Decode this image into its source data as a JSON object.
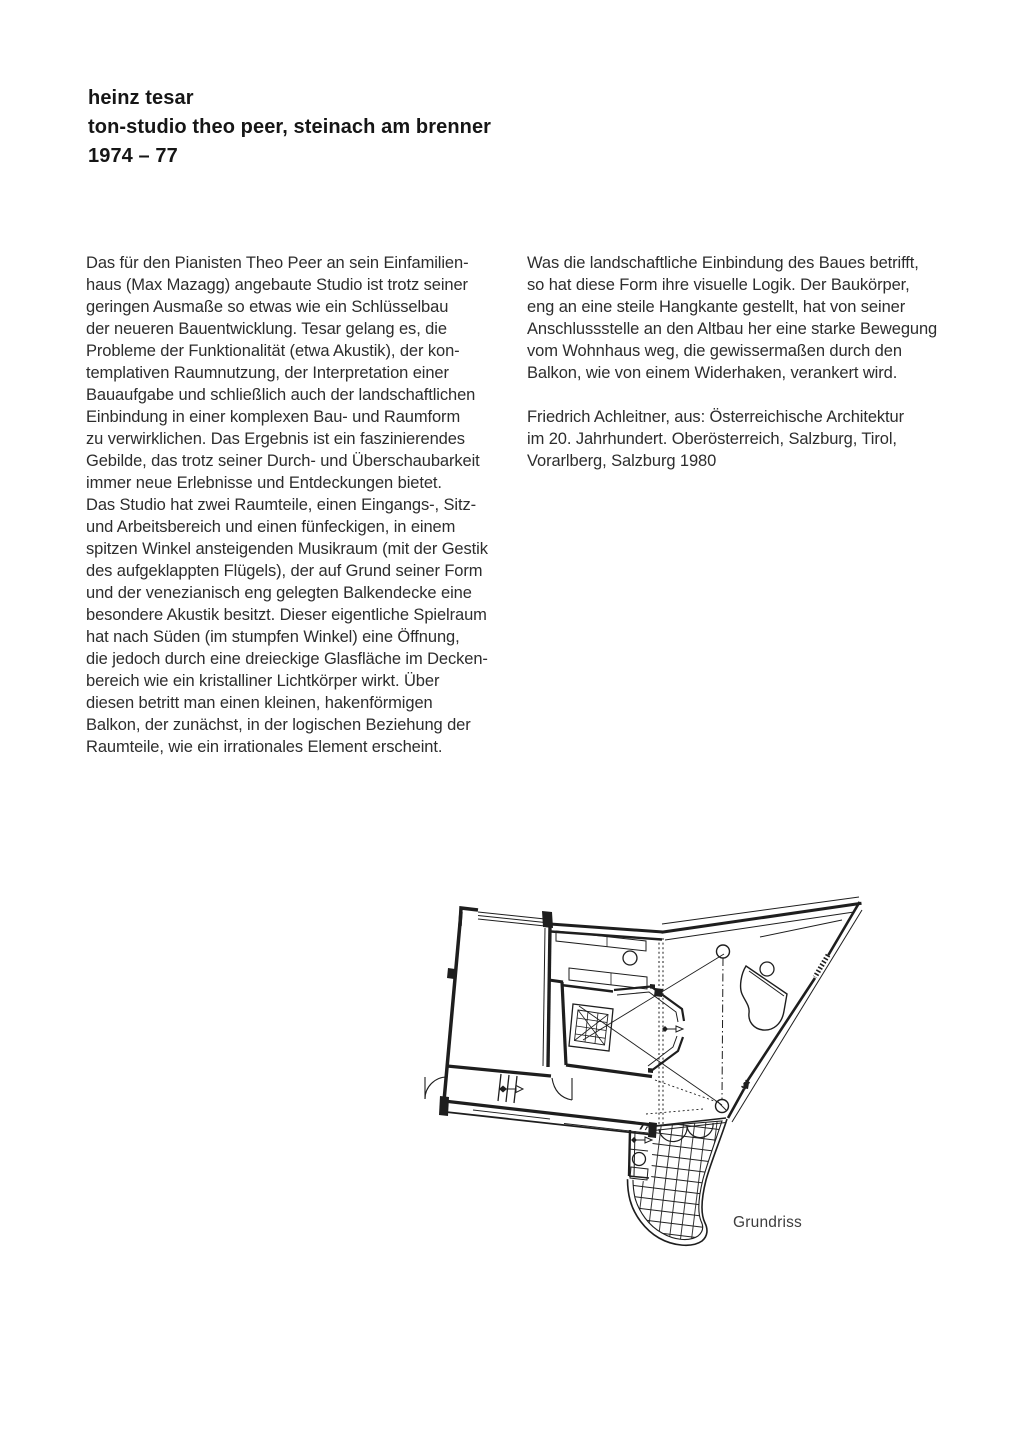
{
  "colors": {
    "background": "#ffffff",
    "text": "#2d2d2d",
    "heading": "#161616",
    "ink": "#1e1e1e",
    "caption": "#3d3d3d"
  },
  "header": {
    "line1": "heinz tesar",
    "line2": "ton-studio theo peer, steinach am brenner",
    "line3": "1974 – 77"
  },
  "columns": {
    "left_lines": [
      "Das für den Pianisten Theo Peer an sein Einfamilien-",
      "haus (Max Mazagg) angebaute Studio ist trotz seiner",
      "geringen Ausmaße so etwas wie ein Schlüsselbau",
      "der neueren Bauentwicklung. Tesar gelang es, die",
      "Probleme der Funktionalität (etwa Akustik), der kon-",
      "templativen Raumnutzung, der Interpretation einer",
      "Bauaufgabe und schließlich auch der landschaftlichen",
      "Einbindung in einer komplexen Bau- und Raumform",
      "zu verwirklichen. Das Ergebnis ist ein faszinierendes",
      "Gebilde, das trotz seiner Durch- und Überschaubarkeit",
      "immer neue Erlebnisse und Entdeckungen bietet.",
      "Das Studio hat zwei Raumteile, einen Eingangs-, Sitz-",
      "und Arbeitsbereich und einen fünfeckigen, in einem",
      "spitzen Winkel ansteigenden Musikraum (mit der Gestik",
      "des aufgeklappten Flügels), der auf Grund seiner Form",
      "und der venezianisch eng gelegten Balkendecke eine",
      "besondere Akustik besitzt. Dieser eigentliche Spielraum",
      "hat nach Süden (im stumpfen Winkel) eine Öffnung,",
      "die jedoch durch eine dreieckige Glasfläche im Decken-",
      "bereich wie ein kristalliner Lichtkörper wirkt. Über",
      "diesen betritt man einen kleinen, hakenförmigen",
      "Balkon, der zunächst, in der logischen Beziehung der",
      "Raumteile, wie ein irrationales Element erscheint."
    ],
    "right_para1_lines": [
      "Was die landschaftliche Einbindung des Baues betrifft,",
      "so hat diese Form ihre visuelle Logik. Der Baukörper,",
      "eng an eine steile Hangkante gestellt, hat von seiner",
      "Anschlussstelle an den Altbau her eine starke Bewegung",
      "vom Wohnhaus weg, die gewissermaßen durch den",
      "Balkon, wie von einem Widerhaken, verankert wird."
    ],
    "right_para2_lines": [
      "Friedrich Achleitner, aus: Österreichische Architektur",
      "im 20. Jahrhundert. Oberösterreich, Salzburg, Tirol,",
      "Vorarlberg, Salzburg 1980"
    ]
  },
  "figure": {
    "caption": "Grundriss"
  }
}
